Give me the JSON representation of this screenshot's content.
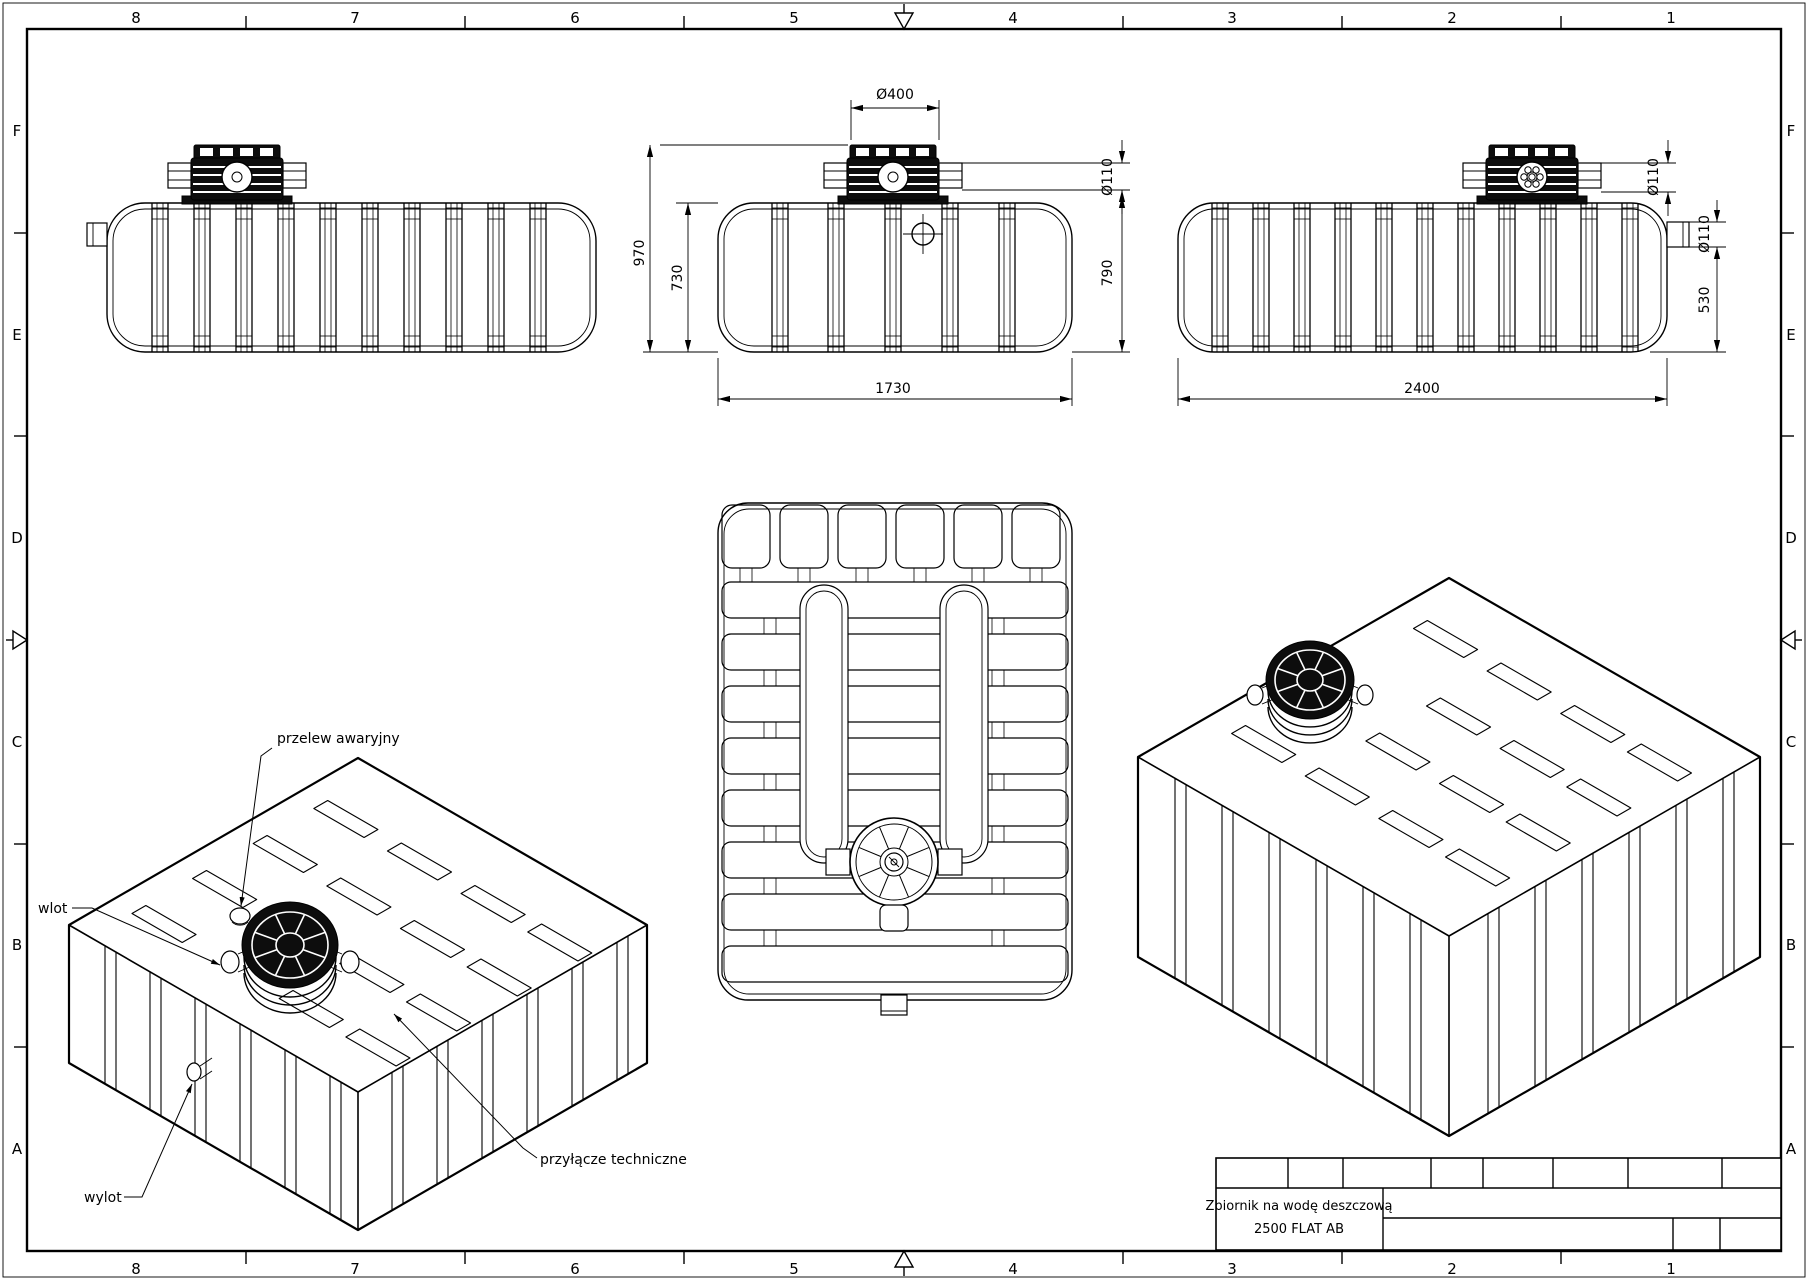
{
  "frame": {
    "columns": [
      "8",
      "7",
      "6",
      "5",
      "4",
      "3",
      "2",
      "1"
    ],
    "rows": [
      "F",
      "E",
      "D",
      "C",
      "B",
      "A"
    ]
  },
  "title_block": {
    "line1": "Zbiornik na wodę deszczową",
    "line2": "2500 FLAT AB"
  },
  "dimensions": {
    "front": {
      "lid": "Ø400",
      "pipe": "Ø110",
      "height_total": "970",
      "height_body_left": "730",
      "height_body_right": "790",
      "width": "1730"
    },
    "side": {
      "lid_pipe": "Ø110",
      "port": "Ø110",
      "port_height": "530",
      "length": "2400"
    }
  },
  "annotations": {
    "overflow": "przelew awaryjny",
    "inlet": "wlot",
    "outlet": "wylot",
    "technical": "przyłącze techniczne"
  },
  "colors": {
    "line": "#000000",
    "background": "#ffffff",
    "lid_fill": "#0d0d0d"
  }
}
